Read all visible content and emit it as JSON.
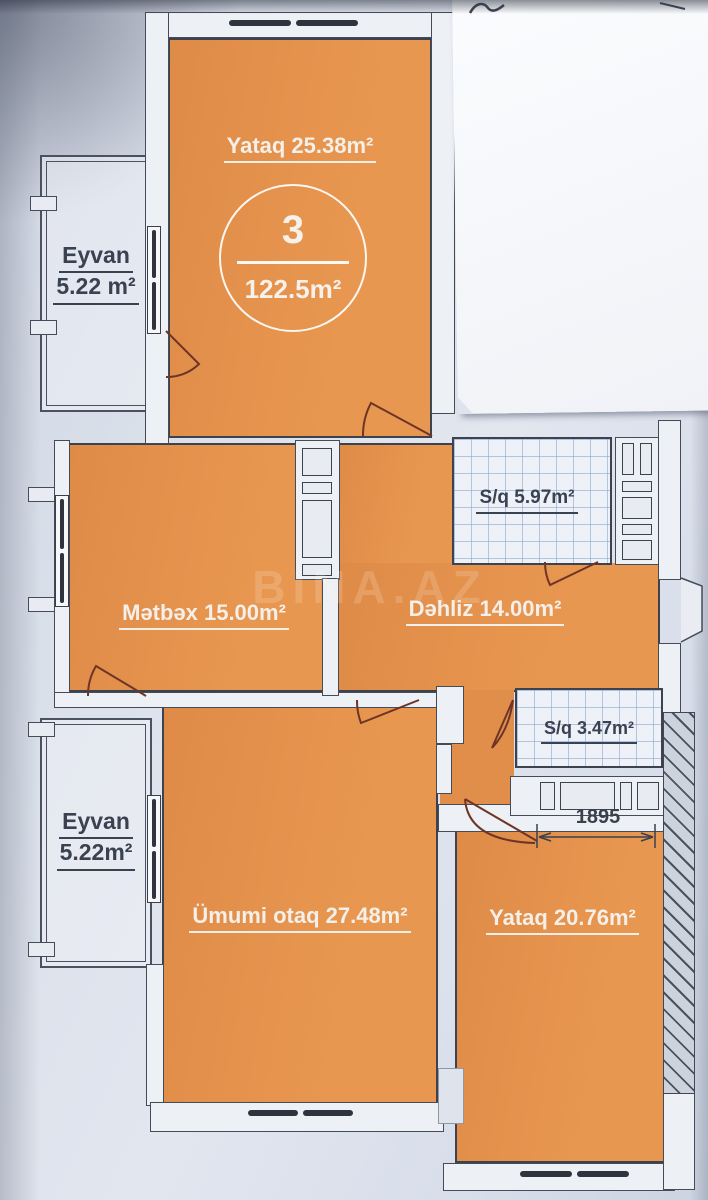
{
  "badge": {
    "number": "3",
    "total_area": "122.5m²"
  },
  "watermark": {
    "text": "BINA.AZ"
  },
  "dimension": {
    "value": "1895"
  },
  "rooms": {
    "yataq_top": {
      "label": "Yataq 25.38m²"
    },
    "eyvan_top": {
      "name": "Eyvan",
      "area": "5.22 m²"
    },
    "metbex": {
      "label": "Mətbəx 15.00m²"
    },
    "dehliz": {
      "label": "Dəhliz 14.00m²"
    },
    "sq_top": {
      "label": "S/q 5.97m²"
    },
    "sq_bottom": {
      "label": "S/q 3.47m²"
    },
    "umumi": {
      "label": "Ümumi otaq 27.48m²"
    },
    "yataq_bottom": {
      "label": "Yataq 20.76m²"
    },
    "eyvan_bottom": {
      "name": "Eyvan",
      "area": "5.22m²"
    }
  },
  "colors": {
    "room_fill": "#e2904e",
    "wall_outline": "#3d434e",
    "door_arc": "#6e3527",
    "tile_line": "#82a0c8",
    "paper": "#dbe0ea",
    "sheet": "#f8f9fb",
    "label_light": "#f4efe8",
    "label_dark": "#3a4150",
    "hatch_line": "#4a5260"
  }
}
